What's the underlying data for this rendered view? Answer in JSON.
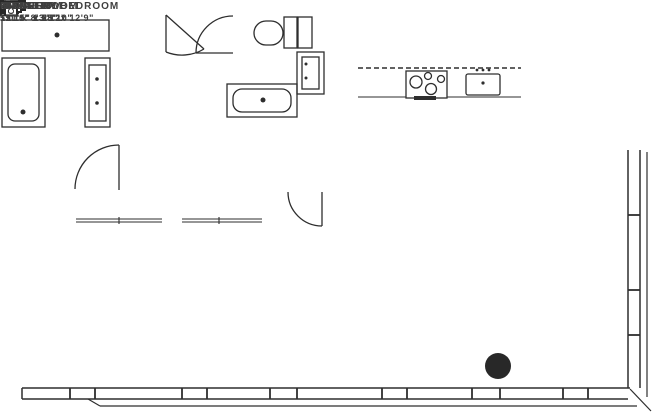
{
  "plan_title": "apartment-floor-plan",
  "rooms": {
    "foyer": {
      "name": "FOYER",
      "dims": "5'0\" x 8'3\""
    },
    "gallery": {
      "name": "GALLERY",
      "dims": "15'11\" x 5'1\""
    },
    "kitchen": {
      "name": "KITCHEN",
      "dims": ""
    },
    "great_room": {
      "name": "GREAT ROOM",
      "dims": "21'5\" x 25'10\""
    },
    "master_bedroom": {
      "name": "MASTER BEDROOM",
      "dims": "13'8\" x 12'9\""
    },
    "bedroom": {
      "name": "BEDROOM",
      "dims": "11'10\" x 13'2\""
    }
  },
  "labels": {
    "closet": "CL",
    "washer_dryer": "WD",
    "refrigerator": "REF",
    "dishwasher": "DW",
    "storage": "SO/WR"
  },
  "colors": {
    "wall": "#282828",
    "line": "#2e2e2e",
    "background": "#ffffff",
    "text": "#3f3f3f"
  }
}
